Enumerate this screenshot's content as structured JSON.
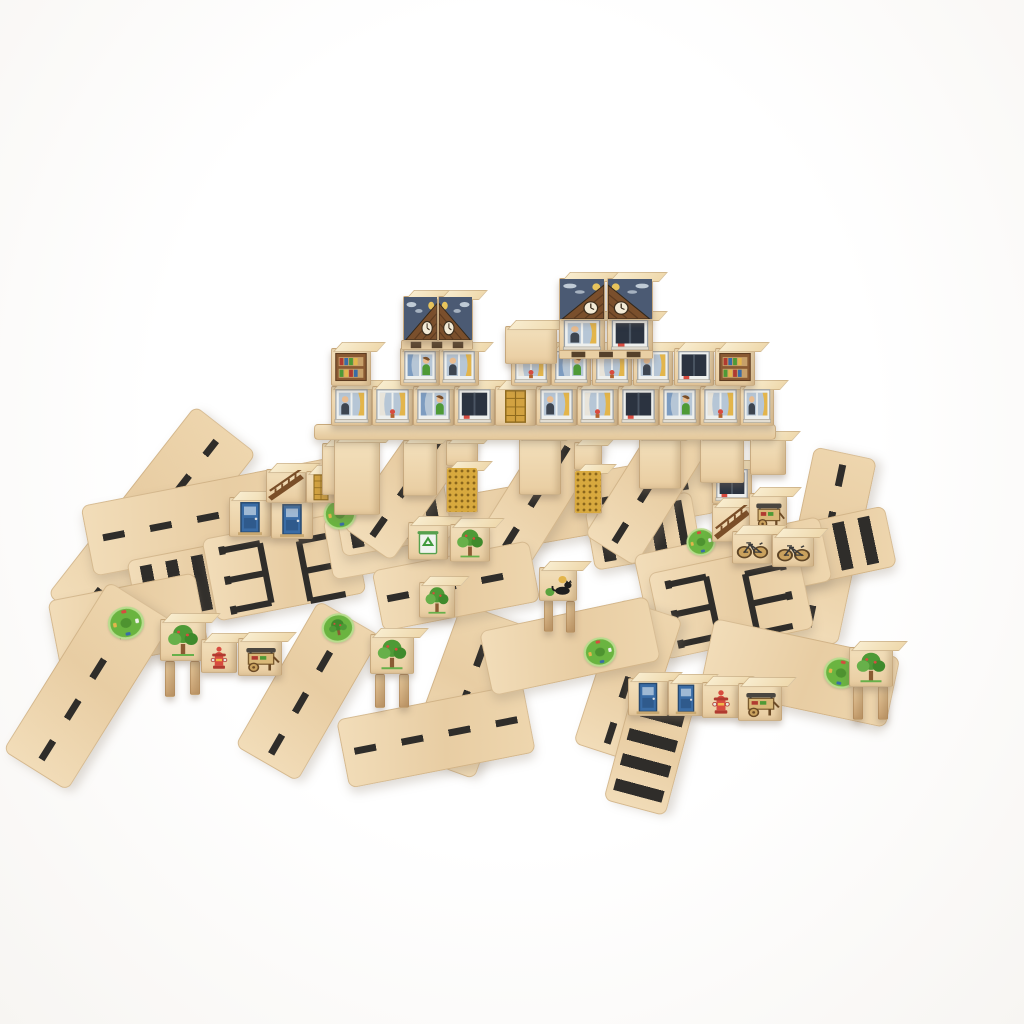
{
  "meta": {
    "description": "Product photo of a natural wooden toy block city on a white background: printed cube blocks stacked into towers (windows with people, night-sky clock roofs, slatted pallets) standing on a long block bridge with golden honeycomb pillars, surrounded by flat wooden road planks printed with black dashed lanes, zebra crosswalks and parking bays, green roundabout and park circles, and small printed blocks: trees, blue doors, golden doors, bicycles, fire hydrants, vendor carts, a recycling bin, a bookshelf and a black cat."
  },
  "palette": {
    "wood": "#e9cda1",
    "woodL": "#f3e0bc",
    "woodD": "#d9b98c",
    "edge": "#c89f6e",
    "mark": "#2f2d2a",
    "navy": "#4b5a73",
    "gold": "#d8a93e",
    "goldDot": "#8a661c",
    "green": "#5aa33e",
    "greenD": "#3e8a2b",
    "red": "#d84b3f",
    "blue": "#3a6ca5",
    "skin": "#eabd90",
    "curtain": "#e3b54b",
    "pane": "#b6c6d6",
    "roofBrown": "#7a4f2c"
  },
  "scene": {
    "width": 1024,
    "height": 1024,
    "pieces": [
      {
        "n": "road-diagonal-topleft",
        "k": "road",
        "g": "dash",
        "x": 152,
        "y": 524,
        "w": 240,
        "h": 78,
        "r": -52
      },
      {
        "n": "road-left-band",
        "k": "road",
        "g": "dash",
        "x": 212,
        "y": 517,
        "w": 255,
        "h": 72,
        "r": -11
      },
      {
        "n": "crosswalk-left",
        "k": "road",
        "g": "zebra",
        "x": 196,
        "y": 584,
        "w": 128,
        "h": 72,
        "r": -11
      },
      {
        "n": "road-left-roundabout",
        "k": "road",
        "g": "plain",
        "x": 128,
        "y": 623,
        "w": 150,
        "h": 74,
        "r": -11
      },
      {
        "n": "road-bottomleft-diagonal",
        "k": "road",
        "g": "dash",
        "x": 88,
        "y": 686,
        "w": 200,
        "h": 76,
        "r": -58
      },
      {
        "n": "parking-lot-left",
        "k": "road",
        "g": "parking",
        "x": 284,
        "y": 566,
        "w": 152,
        "h": 84,
        "r": -11
      },
      {
        "n": "road-mid-band",
        "k": "road",
        "g": "dash",
        "x": 520,
        "y": 516,
        "w": 390,
        "h": 62,
        "r": -10
      },
      {
        "n": "crosswalk-mid-left",
        "k": "road",
        "g": "zebra",
        "x": 393,
        "y": 517,
        "w": 112,
        "h": 62,
        "r": -10
      },
      {
        "n": "crosswalk-mid-right",
        "k": "road",
        "g": "zebra",
        "x": 643,
        "y": 531,
        "w": 108,
        "h": 62,
        "r": -10
      },
      {
        "n": "road-under-bridge-1",
        "k": "road",
        "g": "dash",
        "x": 410,
        "y": 483,
        "w": 150,
        "h": 60,
        "r": -55
      },
      {
        "n": "road-under-bridge-2",
        "k": "road",
        "g": "dash",
        "x": 540,
        "y": 492,
        "w": 150,
        "h": 60,
        "r": -58
      },
      {
        "n": "road-under-bridge-3",
        "k": "road",
        "g": "dash",
        "x": 652,
        "y": 483,
        "w": 160,
        "h": 60,
        "r": -58
      },
      {
        "n": "road-right-vertical",
        "k": "road",
        "g": "dash",
        "x": 826,
        "y": 546,
        "w": 190,
        "h": 64,
        "r": -78
      },
      {
        "n": "crosswalk-right",
        "k": "road",
        "g": "zebra",
        "x": 833,
        "y": 548,
        "w": 118,
        "h": 62,
        "r": -12
      },
      {
        "n": "road-right-band",
        "k": "road",
        "g": "plain",
        "x": 733,
        "y": 568,
        "w": 190,
        "h": 66,
        "r": -12
      },
      {
        "n": "parking-lot-right",
        "k": "road",
        "g": "parking",
        "x": 731,
        "y": 601,
        "w": 152,
        "h": 88,
        "r": -12
      },
      {
        "n": "road-bottomright",
        "k": "road",
        "g": "plain",
        "x": 800,
        "y": 673,
        "w": 190,
        "h": 72,
        "r": 12
      },
      {
        "n": "road-center-vertical-left",
        "k": "road",
        "g": "dash",
        "x": 308,
        "y": 691,
        "w": 168,
        "h": 72,
        "r": -60
      },
      {
        "n": "road-center-vertical",
        "k": "road",
        "g": "dash",
        "x": 468,
        "y": 691,
        "w": 162,
        "h": 72,
        "r": -70
      },
      {
        "n": "road-bottom-center",
        "k": "road",
        "g": "dash",
        "x": 436,
        "y": 736,
        "w": 190,
        "h": 70,
        "r": -11
      },
      {
        "n": "road-bottomright-vertical",
        "k": "road",
        "g": "dash",
        "x": 628,
        "y": 681,
        "w": 152,
        "h": 66,
        "r": -72
      },
      {
        "n": "crosswalk-bottom",
        "k": "road",
        "g": "zebra",
        "x": 650,
        "y": 749,
        "w": 122,
        "h": 64,
        "r": -75
      },
      {
        "n": "road-center-band",
        "k": "road",
        "g": "plain",
        "x": 570,
        "y": 646,
        "w": 172,
        "h": 66,
        "r": -12
      },
      {
        "n": "road-center-band-2",
        "k": "road",
        "g": "dash",
        "x": 456,
        "y": 586,
        "w": 160,
        "h": 62,
        "r": -11
      },
      {
        "n": "roundabout-decal-1",
        "k": "decal",
        "g": "roundabout",
        "x": 340,
        "y": 514,
        "w": 36,
        "h": 34,
        "r": -11
      },
      {
        "n": "roundabout-decal-2",
        "k": "decal",
        "g": "roundabout",
        "x": 126,
        "y": 623,
        "w": 40,
        "h": 36,
        "r": -11
      },
      {
        "n": "park-circle-decal",
        "k": "decal",
        "g": "park",
        "x": 338,
        "y": 628,
        "w": 36,
        "h": 32,
        "r": -11
      },
      {
        "n": "roundabout-decal-3",
        "k": "decal",
        "g": "roundabout",
        "x": 600,
        "y": 652,
        "w": 36,
        "h": 32,
        "r": -12
      },
      {
        "n": "roundabout-decal-4",
        "k": "decal",
        "g": "roundabout",
        "x": 841,
        "y": 673,
        "w": 38,
        "h": 34,
        "r": 12
      },
      {
        "n": "roundabout-decal-5",
        "k": "decal",
        "g": "roundabout",
        "x": 701,
        "y": 542,
        "w": 32,
        "h": 30,
        "r": -12
      },
      {
        "n": "block-door-blue-1",
        "k": "cube",
        "g": "door-blue",
        "x": 250,
        "y": 517,
        "w": 42,
        "h": 40,
        "r": 0
      },
      {
        "n": "block-door-blue-2",
        "k": "cube",
        "g": "door-blue",
        "x": 292,
        "y": 519,
        "w": 42,
        "h": 40,
        "r": 0
      },
      {
        "n": "block-truss-1",
        "k": "cube",
        "g": "truss",
        "x": 286,
        "y": 486,
        "w": 40,
        "h": 34,
        "r": 0
      },
      {
        "n": "block-door-gold-1",
        "k": "cube",
        "g": "door-gold",
        "x": 321,
        "y": 487,
        "w": 30,
        "h": 32,
        "r": 0
      },
      {
        "n": "block-plain-1",
        "k": "cube",
        "g": "plain",
        "x": 343,
        "y": 469,
        "w": 42,
        "h": 52,
        "r": 0
      },
      {
        "n": "block-recycle",
        "k": "cube",
        "g": "recycle",
        "x": 428,
        "y": 541,
        "w": 40,
        "h": 38,
        "r": 0
      },
      {
        "n": "block-tree-1",
        "k": "cube",
        "g": "tree",
        "x": 470,
        "y": 543,
        "w": 40,
        "h": 38,
        "r": 0
      },
      {
        "n": "block-tree-2",
        "k": "cube",
        "g": "tree",
        "x": 437,
        "y": 600,
        "w": 36,
        "h": 36,
        "r": 0
      },
      {
        "n": "cat-stool-leg-1",
        "k": "cube",
        "g": "leg",
        "x": 548,
        "y": 616,
        "w": 9,
        "h": 32,
        "r": 0
      },
      {
        "n": "cat-stool-leg-2",
        "k": "cube",
        "g": "leg",
        "x": 570,
        "y": 617,
        "w": 9,
        "h": 32,
        "r": 0
      },
      {
        "n": "block-cat",
        "k": "cube",
        "g": "cat",
        "x": 558,
        "y": 584,
        "w": 38,
        "h": 34,
        "r": 0
      },
      {
        "n": "block-window-right",
        "k": "cube",
        "g": "win-dark",
        "x": 732,
        "y": 485,
        "w": 40,
        "h": 38,
        "r": 0
      },
      {
        "n": "block-truss-2",
        "k": "cube",
        "g": "truss",
        "x": 732,
        "y": 523,
        "w": 40,
        "h": 38,
        "r": 0
      },
      {
        "n": "block-cart-1",
        "k": "cube",
        "g": "cart",
        "x": 768,
        "y": 513,
        "w": 38,
        "h": 40,
        "r": 0
      },
      {
        "n": "block-bike-1",
        "k": "cube",
        "g": "bike",
        "x": 752,
        "y": 547,
        "w": 40,
        "h": 33,
        "r": 0
      },
      {
        "n": "block-bike-2",
        "k": "cube",
        "g": "bike",
        "x": 793,
        "y": 550,
        "w": 42,
        "h": 33,
        "r": 0
      },
      {
        "n": "stool-left-leg-1",
        "k": "cube",
        "g": "leg",
        "x": 170,
        "y": 679,
        "w": 10,
        "h": 36,
        "r": 0
      },
      {
        "n": "stool-left-leg-2",
        "k": "cube",
        "g": "leg",
        "x": 195,
        "y": 678,
        "w": 10,
        "h": 34,
        "r": 0
      },
      {
        "n": "block-tree-stool-left",
        "k": "cube",
        "g": "tree",
        "x": 183,
        "y": 640,
        "w": 46,
        "h": 42,
        "r": 0
      },
      {
        "n": "block-hydrant-1",
        "k": "cube",
        "g": "hydrant",
        "x": 219,
        "y": 656,
        "w": 36,
        "h": 34,
        "r": 0
      },
      {
        "n": "block-cart-2",
        "k": "cube",
        "g": "cart",
        "x": 260,
        "y": 657,
        "w": 44,
        "h": 38,
        "r": 0
      },
      {
        "n": "stool-center-leg-1",
        "k": "cube",
        "g": "leg",
        "x": 380,
        "y": 691,
        "w": 10,
        "h": 34,
        "r": 0
      },
      {
        "n": "stool-center-leg-2",
        "k": "cube",
        "g": "leg",
        "x": 404,
        "y": 691,
        "w": 10,
        "h": 34,
        "r": 0
      },
      {
        "n": "block-tree-stool-center",
        "k": "cube",
        "g": "tree",
        "x": 392,
        "y": 654,
        "w": 44,
        "h": 40,
        "r": 0
      },
      {
        "n": "stool-right-leg-1",
        "k": "cube",
        "g": "leg",
        "x": 858,
        "y": 703,
        "w": 10,
        "h": 34,
        "r": 0
      },
      {
        "n": "stool-right-leg-2",
        "k": "cube",
        "g": "leg",
        "x": 883,
        "y": 703,
        "w": 10,
        "h": 34,
        "r": 0
      },
      {
        "n": "block-tree-stool-right",
        "k": "cube",
        "g": "tree",
        "x": 871,
        "y": 667,
        "w": 44,
        "h": 40,
        "r": 0
      },
      {
        "n": "block-door-blue-3",
        "k": "cube",
        "g": "door-blue",
        "x": 648,
        "y": 697,
        "w": 40,
        "h": 38,
        "r": 0
      },
      {
        "n": "block-door-blue-4",
        "k": "cube",
        "g": "door-blue",
        "x": 686,
        "y": 698,
        "w": 36,
        "h": 36,
        "r": 0
      },
      {
        "n": "block-hydrant-2",
        "k": "cube",
        "g": "hydrant",
        "x": 721,
        "y": 700,
        "w": 38,
        "h": 36,
        "r": 0
      },
      {
        "n": "block-cart-3",
        "k": "cube",
        "g": "cart",
        "x": 760,
        "y": 702,
        "w": 44,
        "h": 38,
        "r": 0
      },
      {
        "n": "pillar-1",
        "k": "cube",
        "g": "plain",
        "x": 357,
        "y": 477,
        "w": 46,
        "h": 76,
        "r": 0
      },
      {
        "n": "pillar-2",
        "k": "cube",
        "g": "plain",
        "x": 420,
        "y": 468,
        "w": 34,
        "h": 56,
        "r": 0
      },
      {
        "n": "pillar-3",
        "k": "cube",
        "g": "plain",
        "x": 462,
        "y": 453,
        "w": 32,
        "h": 26,
        "r": 0
      },
      {
        "n": "pillar-4-honeycomb",
        "k": "cube",
        "g": "honeycomb",
        "x": 462,
        "y": 490,
        "w": 32,
        "h": 46,
        "r": 0
      },
      {
        "n": "pillar-5",
        "k": "cube",
        "g": "plain",
        "x": 540,
        "y": 466,
        "w": 42,
        "h": 58,
        "r": 0
      },
      {
        "n": "pillar-6",
        "k": "cube",
        "g": "plain",
        "x": 588,
        "y": 456,
        "w": 28,
        "h": 28,
        "r": 0
      },
      {
        "n": "pillar-7-honeycomb",
        "k": "cube",
        "g": "honeycomb",
        "x": 588,
        "y": 492,
        "w": 28,
        "h": 44,
        "r": 0
      },
      {
        "n": "pillar-8",
        "k": "cube",
        "g": "plain",
        "x": 660,
        "y": 463,
        "w": 42,
        "h": 52,
        "r": 0
      },
      {
        "n": "pillar-9",
        "k": "cube",
        "g": "plain",
        "x": 722,
        "y": 460,
        "w": 44,
        "h": 46,
        "r": 0
      },
      {
        "n": "pillar-10",
        "k": "cube",
        "g": "plain",
        "x": 768,
        "y": 456,
        "w": 36,
        "h": 38,
        "r": 0
      },
      {
        "n": "bridge-plank",
        "k": "plank",
        "g": "plain",
        "x": 545,
        "y": 432,
        "w": 462,
        "h": 16,
        "r": 0
      },
      {
        "n": "base-row-window-1",
        "k": "cube",
        "g": "win-man",
        "x": 351,
        "y": 406,
        "w": 41,
        "h": 40,
        "r": 0
      },
      {
        "n": "base-row-window-2",
        "k": "cube",
        "g": "win-curtain",
        "x": 392,
        "y": 406,
        "w": 41,
        "h": 40,
        "r": 0
      },
      {
        "n": "base-row-window-3",
        "k": "cube",
        "g": "win-woman",
        "x": 433,
        "y": 406,
        "w": 41,
        "h": 40,
        "r": 0
      },
      {
        "n": "base-row-window-4",
        "k": "cube",
        "g": "win-dark",
        "x": 474,
        "y": 406,
        "w": 41,
        "h": 40,
        "r": 0
      },
      {
        "n": "base-row-door-gold",
        "k": "cube",
        "g": "door-gold",
        "x": 515,
        "y": 406,
        "w": 41,
        "h": 40,
        "r": 0
      },
      {
        "n": "base-row-window-5",
        "k": "cube",
        "g": "win-man",
        "x": 556,
        "y": 406,
        "w": 41,
        "h": 40,
        "r": 0
      },
      {
        "n": "base-row-window-6",
        "k": "cube",
        "g": "win-curtain",
        "x": 597,
        "y": 406,
        "w": 41,
        "h": 40,
        "r": 0
      },
      {
        "n": "base-row-window-7",
        "k": "cube",
        "g": "win-dark",
        "x": 638,
        "y": 406,
        "w": 41,
        "h": 40,
        "r": 0
      },
      {
        "n": "base-row-window-8",
        "k": "cube",
        "g": "win-woman",
        "x": 679,
        "y": 406,
        "w": 41,
        "h": 40,
        "r": 0
      },
      {
        "n": "base-row-window-9",
        "k": "cube",
        "g": "win-curtain",
        "x": 720,
        "y": 406,
        "w": 41,
        "h": 40,
        "r": 0
      },
      {
        "n": "base-row-window-10",
        "k": "cube",
        "g": "win-man",
        "x": 757,
        "y": 406,
        "w": 34,
        "h": 40,
        "r": 0
      },
      {
        "n": "second-row-shelf-1",
        "k": "cube",
        "g": "shelf",
        "x": 351,
        "y": 367,
        "w": 40,
        "h": 38,
        "r": 0
      },
      {
        "n": "second-row-window-1",
        "k": "cube",
        "g": "win-woman",
        "x": 420,
        "y": 367,
        "w": 40,
        "h": 38,
        "r": 0
      },
      {
        "n": "second-row-window-2",
        "k": "cube",
        "g": "win-man",
        "x": 459,
        "y": 367,
        "w": 40,
        "h": 38,
        "r": 0
      },
      {
        "n": "second-row-window-3",
        "k": "cube",
        "g": "win-curtain",
        "x": 531,
        "y": 367,
        "w": 40,
        "h": 38,
        "r": 0
      },
      {
        "n": "second-row-window-4",
        "k": "cube",
        "g": "win-woman",
        "x": 571,
        "y": 367,
        "w": 40,
        "h": 38,
        "r": 0
      },
      {
        "n": "second-row-window-5",
        "k": "cube",
        "g": "win-curtain",
        "x": 612,
        "y": 367,
        "w": 40,
        "h": 38,
        "r": 0
      },
      {
        "n": "second-row-window-6",
        "k": "cube",
        "g": "win-man",
        "x": 653,
        "y": 367,
        "w": 40,
        "h": 38,
        "r": 0
      },
      {
        "n": "second-row-window-7",
        "k": "cube",
        "g": "win-dark",
        "x": 694,
        "y": 367,
        "w": 40,
        "h": 38,
        "r": 0
      },
      {
        "n": "second-row-shelf-2",
        "k": "cube",
        "g": "shelf",
        "x": 735,
        "y": 367,
        "w": 40,
        "h": 38,
        "r": 0
      },
      {
        "n": "mid-tower-top",
        "k": "cube",
        "g": "plain",
        "x": 531,
        "y": 345,
        "w": 52,
        "h": 38,
        "r": 0
      },
      {
        "n": "left-tower-pallet",
        "k": "cube",
        "g": "pallet",
        "x": 437,
        "y": 345,
        "w": 72,
        "h": 10,
        "r": 0
      },
      {
        "n": "left-tower-roof-left",
        "k": "cube",
        "g": "roofL",
        "x": 420,
        "y": 318,
        "w": 35,
        "h": 45,
        "r": 0
      },
      {
        "n": "left-tower-roof-right",
        "k": "cube",
        "g": "roofR",
        "x": 455,
        "y": 318,
        "w": 35,
        "h": 45,
        "r": 0
      },
      {
        "n": "right-tower-window-1",
        "k": "cube",
        "g": "win-man",
        "x": 582,
        "y": 335,
        "w": 46,
        "h": 36,
        "r": 0
      },
      {
        "n": "right-tower-window-2",
        "k": "cube",
        "g": "win-dark",
        "x": 630,
        "y": 335,
        "w": 46,
        "h": 36,
        "r": 0
      },
      {
        "n": "right-tower-pallet",
        "k": "cube",
        "g": "pallet",
        "x": 606,
        "y": 354,
        "w": 94,
        "h": 9,
        "r": 0
      },
      {
        "n": "right-tower-roof-left",
        "k": "cube",
        "g": "roofL",
        "x": 582,
        "y": 299,
        "w": 46,
        "h": 42,
        "r": 0
      },
      {
        "n": "right-tower-roof-right",
        "k": "cube",
        "g": "roofR",
        "x": 630,
        "y": 299,
        "w": 46,
        "h": 42,
        "r": 0
      }
    ]
  }
}
